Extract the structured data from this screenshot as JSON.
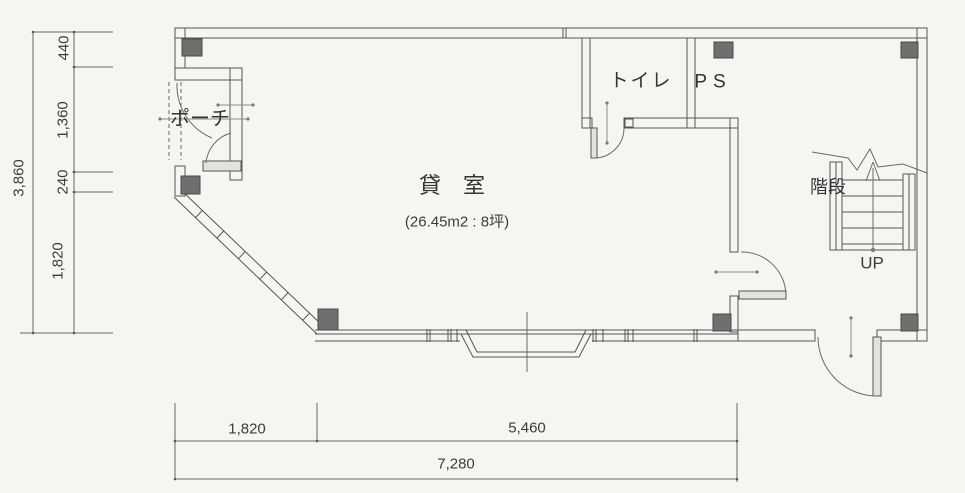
{
  "floor_plan": {
    "rooms": [
      {
        "id": "rental",
        "label": "貸　室",
        "area_label": "(26.45m2 : 8坪)"
      },
      {
        "id": "porch",
        "label": "ポーチ"
      },
      {
        "id": "toilet",
        "label": "トイレ"
      },
      {
        "id": "ps",
        "label": "PS"
      },
      {
        "id": "stairs",
        "label": "階段",
        "direction_label": "UP"
      }
    ],
    "dimensions": {
      "left": {
        "segments": [
          "440",
          "1,360",
          "240",
          "1,820"
        ],
        "total": "3,860"
      },
      "bottom": {
        "segments": [
          "1,820",
          "5,460"
        ],
        "total": "7,280"
      }
    },
    "colors": {
      "background": "#f6f5f2",
      "line": "#555555",
      "column_fill": "#6f6f6f",
      "text": "#3c3c3c"
    }
  }
}
